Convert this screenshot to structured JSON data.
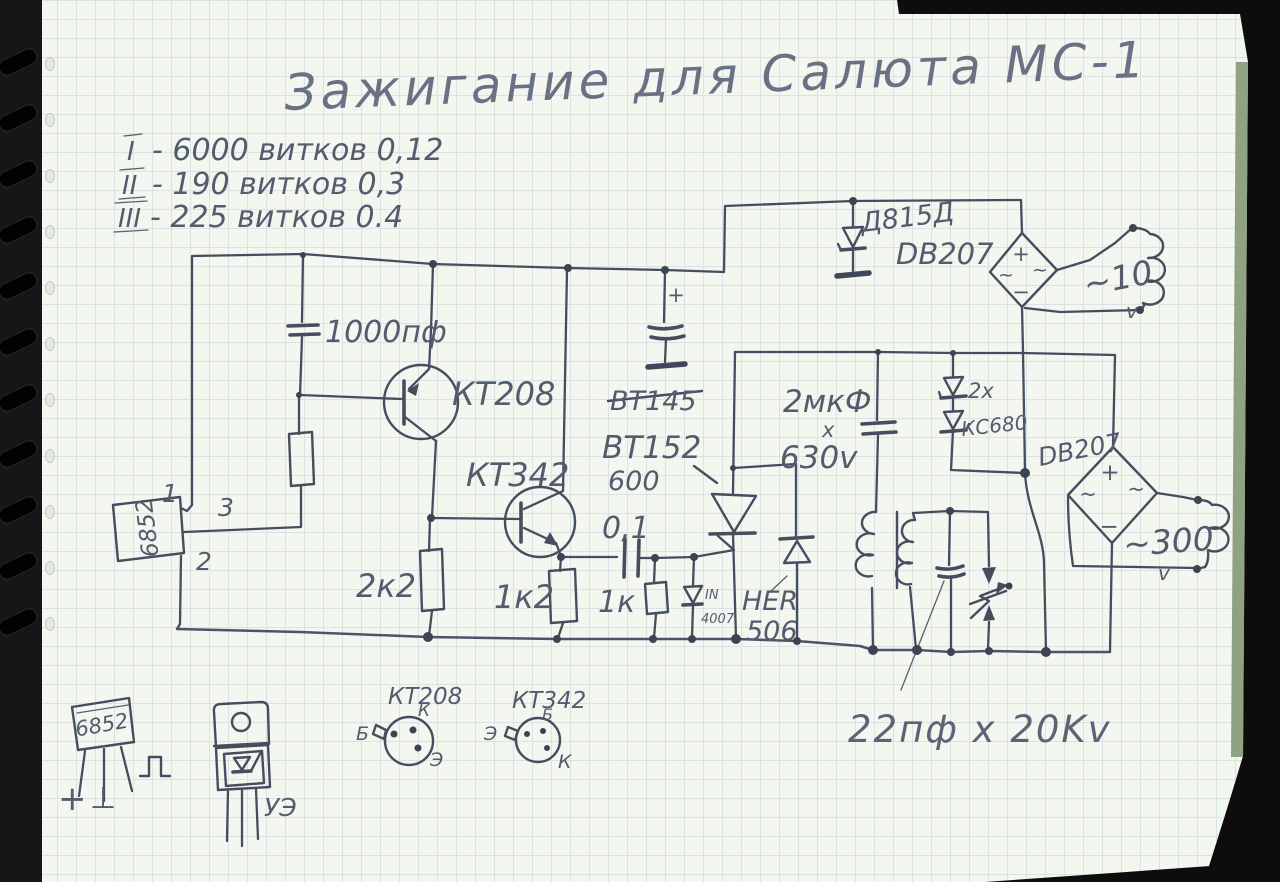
{
  "photo": {
    "paper_color": "#f4f6f0",
    "grid_color": "#d1e2e2",
    "ink_color": "#464d5e"
  },
  "title": "Зажигание для Салюта МС-1",
  "windings": [
    {
      "numeral": "I",
      "text": "- 6000 витков 0,12"
    },
    {
      "numeral": "II",
      "text": "- 190  витков  0,3"
    },
    {
      "numeral": "III",
      "text": "- 225  витков  0.4"
    }
  ],
  "labels": {
    "cap_1000": "1000пф",
    "kt208": "КТ208",
    "kt342": "КТ342",
    "r_2k2": "2к2",
    "r_1k2": "1к2",
    "cap_01": "0,1",
    "r_1k": "1к",
    "diode_in": "IN",
    "diode_4007": "4007",
    "bt145": "ВТ145",
    "bt152": "ВТ152",
    "bt152_volt": "600",
    "her": "HER",
    "her_num": "506",
    "cap_2mkf": "2мкФ",
    "mult": "х",
    "volt_630": "630v",
    "zener_qty": "2х",
    "zener_type": "КС680",
    "db207_left": "DB207",
    "db207_right": "DB207",
    "zener_d815": "Д815Д",
    "coil_10v": "~10",
    "coil_10v_unit": "v",
    "coil_300v": "~300",
    "coil_300v_unit": "v",
    "cap_22pf": "22пф х 20Kv",
    "sensor_6852": "6852",
    "pin1": "1",
    "pin3": "3",
    "pin2": "2",
    "plus": "+",
    "minus": "−",
    "ac": "~"
  },
  "pinouts": {
    "sensor_label": "6852",
    "sensor_plus": "+",
    "sensor_gnd": "⊥",
    "thyristor_gate": "УЭ",
    "kt208_name": "КТ208",
    "kt208_k": "К",
    "kt208_b": "Б",
    "kt208_e": "Э",
    "kt342_name": "КТ342",
    "kt342_b": "Б",
    "kt342_e": "Э",
    "kt342_k": "К"
  }
}
